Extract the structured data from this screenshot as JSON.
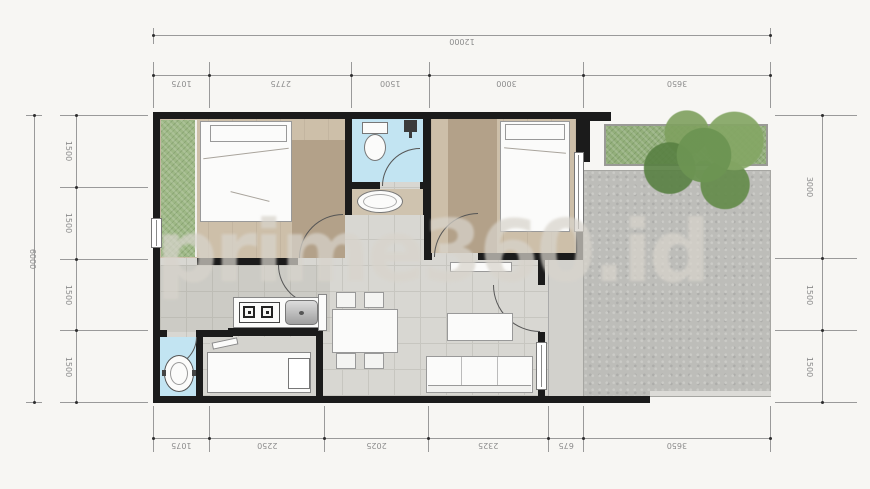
{
  "watermark": {
    "text": "prime360.id"
  },
  "dims": {
    "top_total": {
      "mm": 12000,
      "label": "12000"
    },
    "left_total": {
      "mm": 6000,
      "label": "6000"
    },
    "top": [
      {
        "mm": 1075,
        "label": "1075"
      },
      {
        "mm": 2775,
        "label": "2775"
      },
      {
        "mm": 1500,
        "label": "1500"
      },
      {
        "mm": 3000,
        "label": "3000"
      },
      {
        "mm": 3650,
        "label": "3650"
      }
    ],
    "bottom": [
      {
        "mm": 1075,
        "label": "1075"
      },
      {
        "mm": 2250,
        "label": "2250"
      },
      {
        "mm": 2025,
        "label": "2025"
      },
      {
        "mm": 2325,
        "label": "2325"
      },
      {
        "mm": 675,
        "label": "675"
      },
      {
        "mm": 3650,
        "label": "3650"
      }
    ],
    "left": [
      {
        "mm": 1500,
        "label": "1500"
      },
      {
        "mm": 1500,
        "label": "1500"
      },
      {
        "mm": 1500,
        "label": "1500"
      },
      {
        "mm": 1500,
        "label": "1500"
      }
    ],
    "right": [
      {
        "mm": 3000,
        "label": "3000"
      },
      {
        "mm": 1500,
        "label": "1500"
      },
      {
        "mm": 1500,
        "label": "1500"
      }
    ]
  },
  "colors": {
    "bg": "#f7f6f3",
    "wall": "#1b1b1b",
    "tile": "#d8d7d2",
    "tileline": "#c7c6c0",
    "wood": "#cdbfa9",
    "woodDark": "#b3a189",
    "blue": "#c2e4f2",
    "grass": "#9eb886",
    "hedge": "#93af7b",
    "gravel": "#bdbdb9",
    "porch": "#d2d1cc",
    "watermark": "#d8d4cc",
    "dimline": "#9a9a9a",
    "dimtext": "#8c8c8c"
  }
}
